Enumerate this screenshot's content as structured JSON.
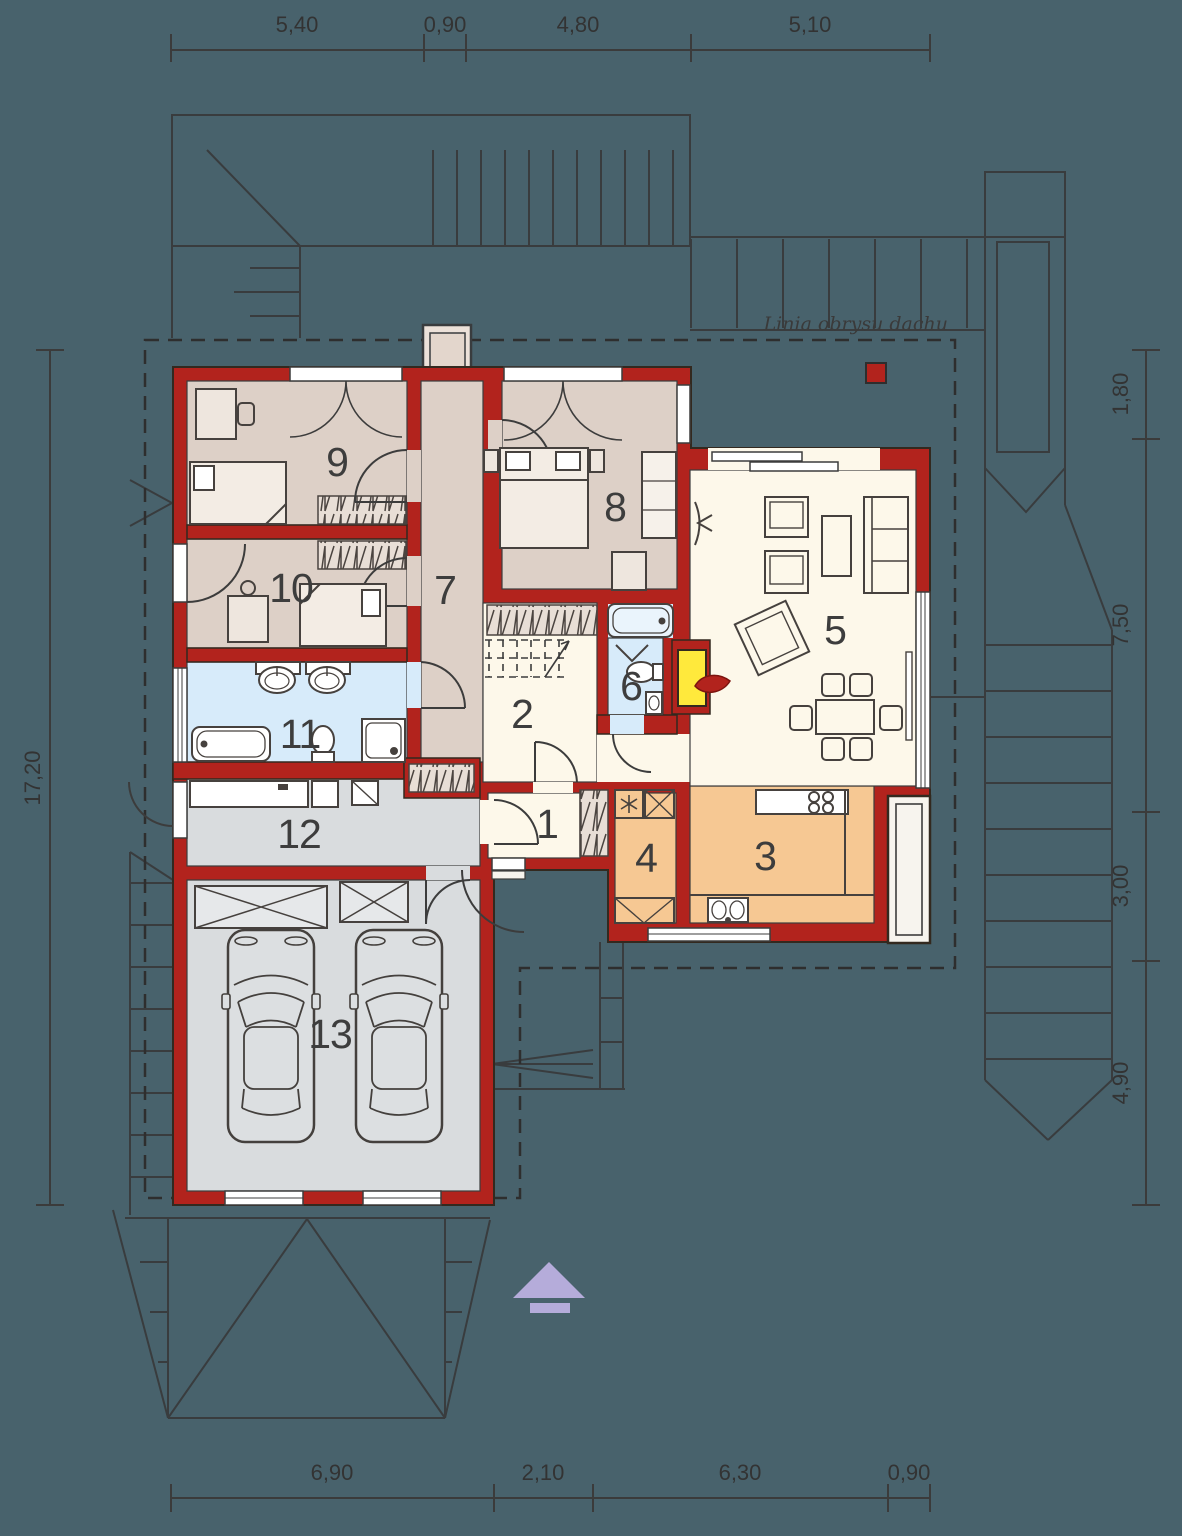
{
  "plan": {
    "type": "floor-plan",
    "floor_rooms_total": 13,
    "rooms": {
      "r1": "1",
      "r2": "2",
      "r3": "3",
      "r4": "4",
      "r5": "5",
      "r6": "6",
      "r7": "7",
      "r8": "8",
      "r9": "9",
      "r10": "10",
      "r11": "11",
      "r12": "12",
      "r13": "13"
    },
    "dims": {
      "top": [
        "5,40",
        "0,90",
        "4,80",
        "5,10"
      ],
      "bottom": [
        "6,90",
        "2,10",
        "6,30",
        "0,90"
      ],
      "left": [
        "17,20"
      ],
      "right": [
        "1,80",
        "7,50",
        "3,00",
        "4,90"
      ]
    },
    "labels": {
      "roof_outline": "Linia obrysu dachu"
    },
    "colors": {
      "background": "#48626c",
      "wall_red": "#b2231d",
      "room_bedroom": "#ddd0c7",
      "room_living": "#fdf8ea",
      "room_bath": "#d7ebfa",
      "room_kitchen": "#f6c893",
      "room_garage": "#d9dcde",
      "fireplace_yellow": "#ffe93c",
      "north_arrow": "#b5acda",
      "line": "#393c3e"
    }
  }
}
